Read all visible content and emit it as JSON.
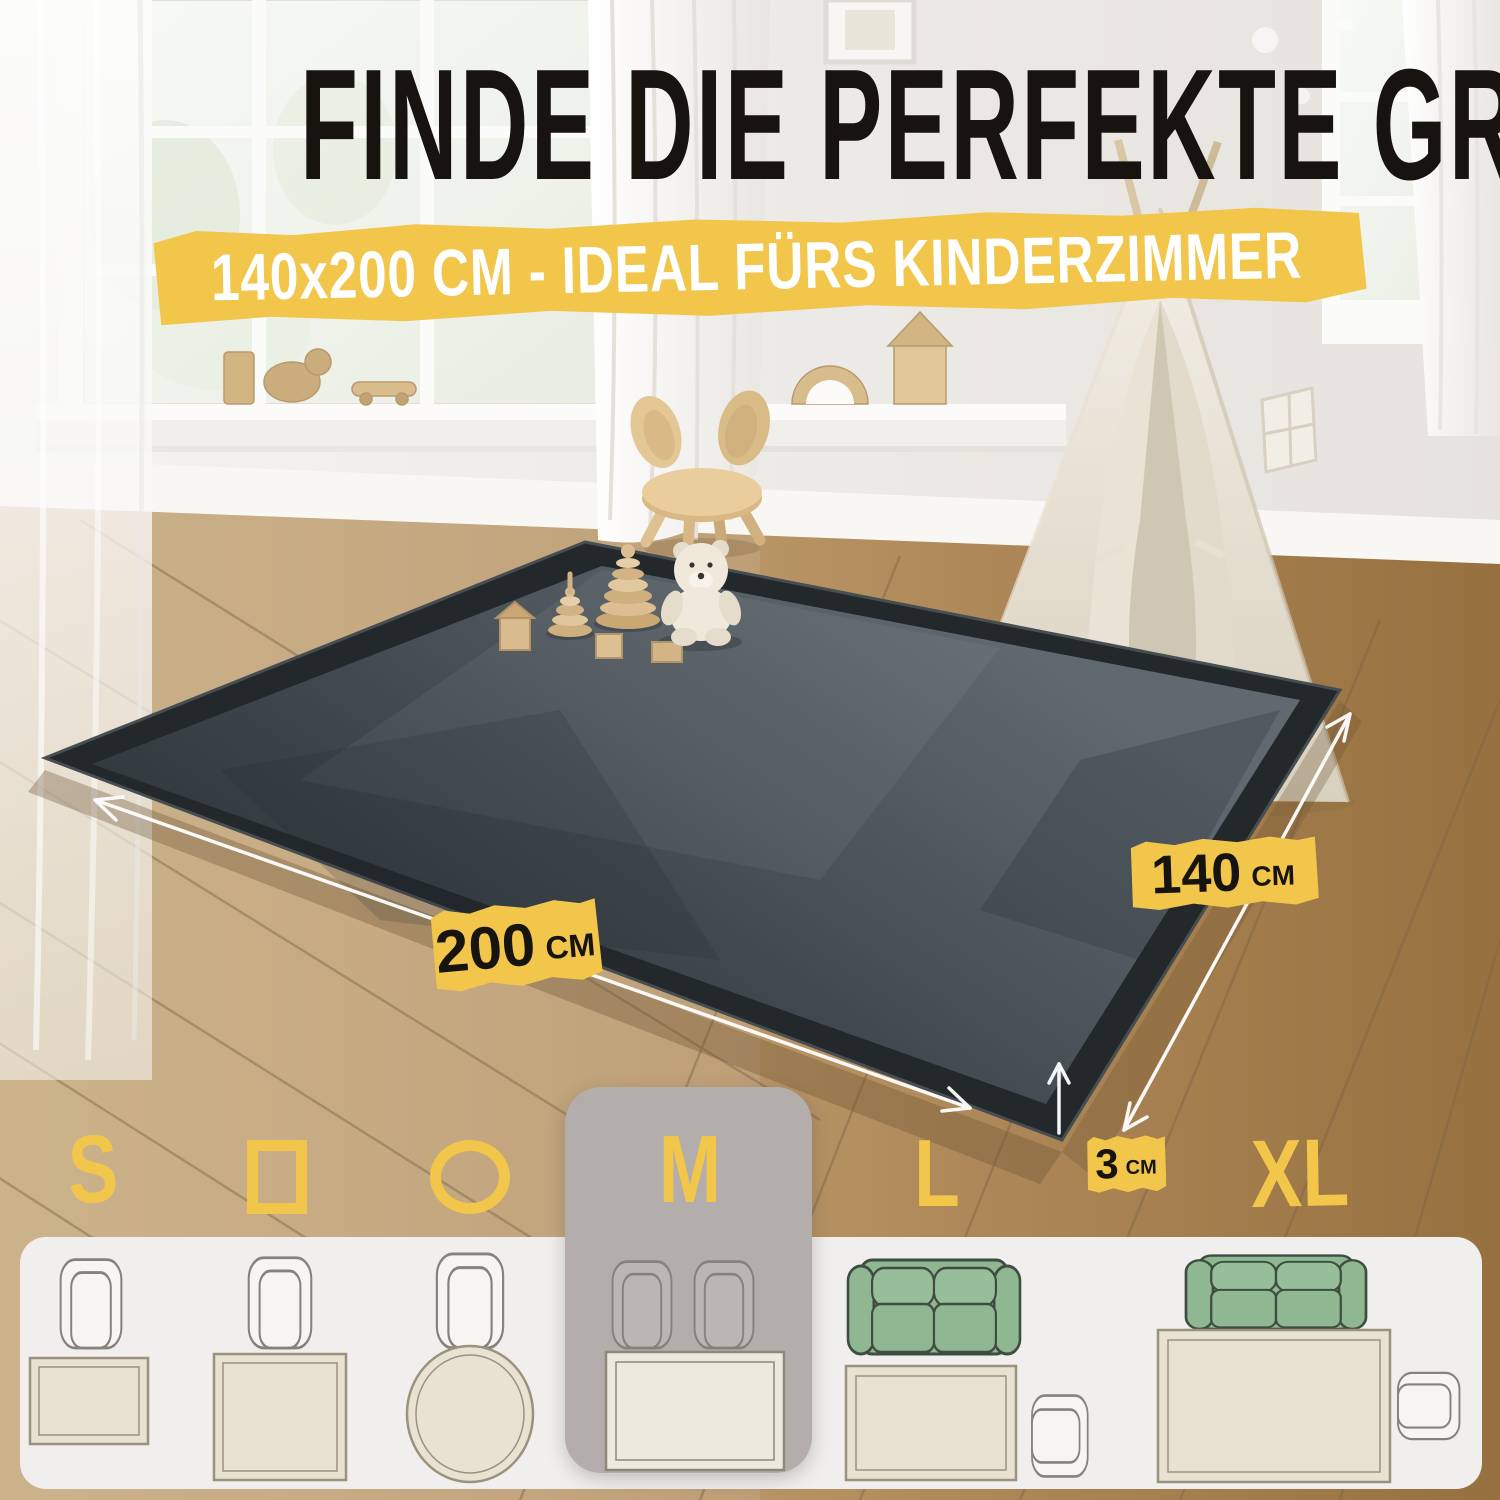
{
  "headline": "FINDE DIE PERFEKTE GRÖSSE",
  "banner": {
    "text": "140x200 CM - IDEAL FÜRS KINDERZIMMER"
  },
  "dimension_labels": {
    "length": {
      "value": "200",
      "unit": "CM"
    },
    "width": {
      "value": "140",
      "unit": "CM"
    },
    "thickness": {
      "value": "3",
      "unit": "CM"
    }
  },
  "size_selector": {
    "selected": "M",
    "options": [
      {
        "id": "s",
        "kind": "text",
        "label": "S"
      },
      {
        "id": "rectangle",
        "kind": "icon",
        "icon": "rectangle-outline-icon"
      },
      {
        "id": "circle",
        "kind": "icon",
        "icon": "circle-outline-icon"
      },
      {
        "id": "m",
        "kind": "text",
        "label": "M",
        "selected": true
      },
      {
        "id": "l",
        "kind": "text",
        "label": "L"
      },
      {
        "id": "xl",
        "kind": "text",
        "label": "XL"
      }
    ]
  },
  "colors": {
    "accent_yellow": "#F1C64B",
    "headline_black": "#17130E",
    "banner_text_white": "#FFFFFF",
    "rug_charcoal": "#3E4549",
    "selected_card_gray": "#B3AEAB",
    "panel_white": "#F0EFED",
    "sofa_green": "#8FB892",
    "icon_rug_beige": "#E7E2D2",
    "floor_wood_brown": "#AF8A5D"
  }
}
